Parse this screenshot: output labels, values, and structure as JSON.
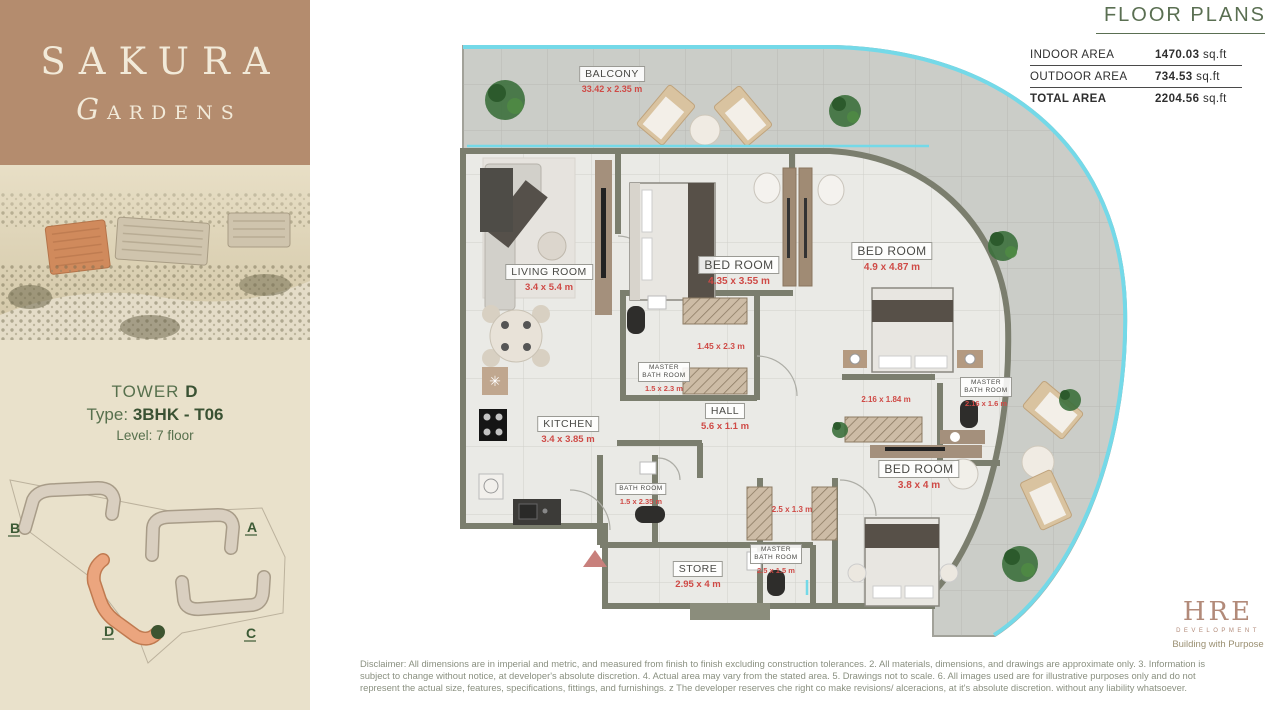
{
  "brand": {
    "name": "SAKURA",
    "sub": "GARDENS"
  },
  "unit": {
    "tower_label": "TOWER",
    "tower_value": "D",
    "type_label": "Type:",
    "type_value": "3BHK - T06",
    "level_label": "Level:",
    "level_value": "7 floor"
  },
  "site_plan": {
    "buildings": [
      {
        "label": "A"
      },
      {
        "label": "B"
      },
      {
        "label": "C"
      },
      {
        "label": "D"
      }
    ]
  },
  "header": {
    "title": "FLOOR PLANS"
  },
  "areas": {
    "rows": [
      {
        "label": "INDOOR AREA",
        "value": "1470.03",
        "unit": " sq.ft"
      },
      {
        "label": "OUTDOOR AREA",
        "value": "734.53",
        "unit": " sq.ft"
      },
      {
        "label": "TOTAL AREA",
        "value": "2204.56",
        "unit": " sq.ft"
      }
    ]
  },
  "floor_plan": {
    "rooms": [
      {
        "name": "BALCONY",
        "dim": "33.42 x 2.35 m"
      },
      {
        "name": "LIVING ROOM",
        "dim": "3.4 x 5.4 m"
      },
      {
        "name": "BED ROOM",
        "dim": "4.35 x 3.55 m"
      },
      {
        "name": "BED ROOM",
        "dim": "4.9 x 4.87 m"
      },
      {
        "name": "MASTER BATH ROOM",
        "dim": "1.5 x 2.3 m"
      },
      {
        "name": "HALL",
        "dim": "5.6 x 1.1 m"
      },
      {
        "name": "KITCHEN",
        "dim": "3.4 x 3.85 m"
      },
      {
        "name": "MASTER BATH ROOM",
        "dim": "2.16 x 1.6 m"
      },
      {
        "name": "BED ROOM",
        "dim": "3.8 x 4 m"
      },
      {
        "name": "BATH ROOM",
        "dim": "1.5 x 2.35 m"
      },
      {
        "name": "MASTER BATH ROOM",
        "dim": "2.5 x 1.5 m"
      },
      {
        "name": "STORE",
        "dim": "2.95 x 4 m"
      }
    ],
    "extra_dims": [
      "1.45 x 2.3 m",
      "2.16 x 1.84 m",
      "2.5 x 1.3 m"
    ]
  },
  "developer": {
    "name": "HRE",
    "sub": "DEVELOPMENT",
    "tagline": "Building with Purpose"
  },
  "disclaimer": "Disclaimer: All dimensions are in imperial and metric, and measured from finish to finish excluding construction tolerances. 2. All materials, dimensions, and drawings are approximate only. 3. Information is subject to change without notice, at developer's absolute discretion. 4. Actual area may vary from the stated area. 5. Drawings not to scale. 6. All images used are for illustrative purposes only and do not represent the actual size, features, specifications, fittings, and furnishings. z The developer reserves che right co make revisions/ alceracions, at it's absolute discretion. without any liability whatsoever.",
  "colors": {
    "accent_green": "#4e6745",
    "dim_red": "#cf4a46",
    "brand_brown": "#b48c6e",
    "panel_beige": "#e9e1cb",
    "railing_cyan": "#74d9e8",
    "wall_olive": "#7b7e6e"
  }
}
